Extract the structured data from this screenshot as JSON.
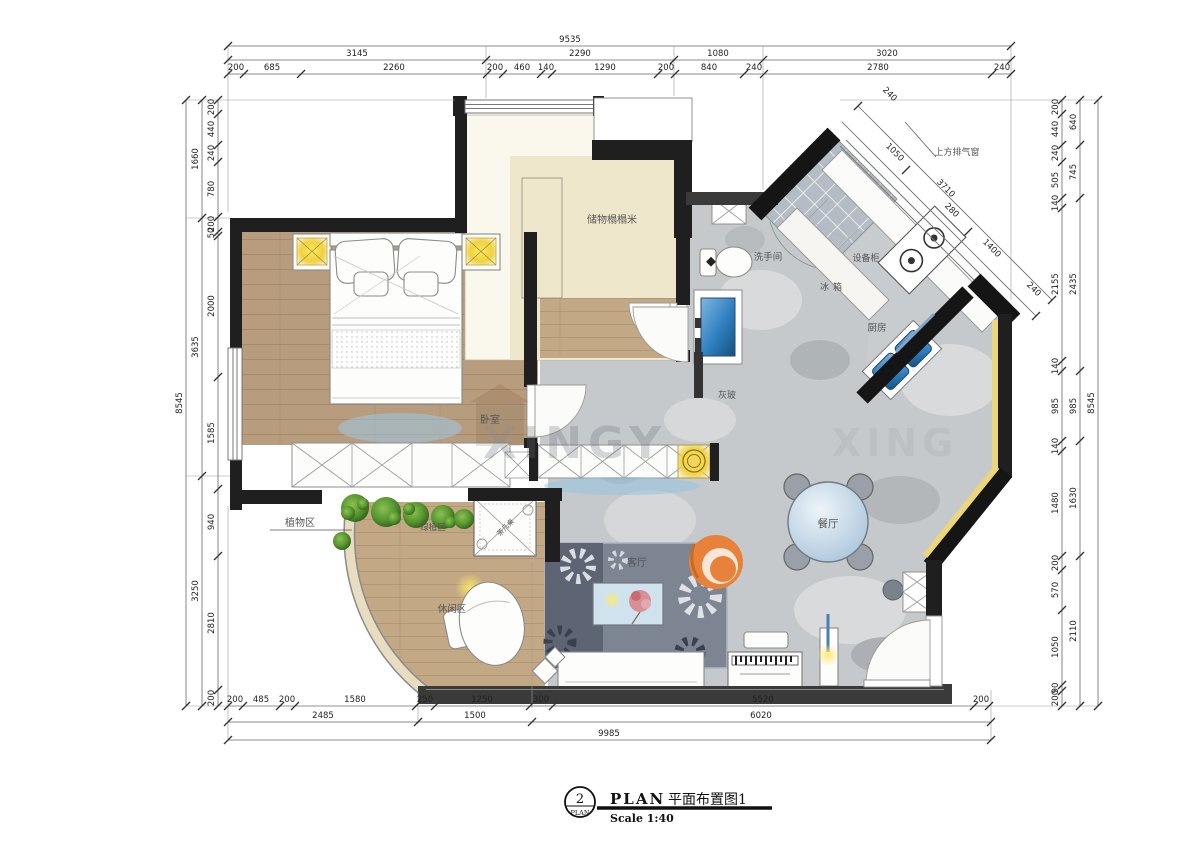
{
  "title_block": {
    "circle_number": "2",
    "circle_text": "PLAN",
    "title_en": "PLAN",
    "title_cn": "平面布置图1",
    "scale": "Scale 1:40"
  },
  "labels": {
    "tatami": "储物榻榻米",
    "bedroom": "卧室",
    "bathroom": "洗手间",
    "gray_glass": "灰玻",
    "exhaust_window": "上方排气窗",
    "equipment_cabinet": "设备柜",
    "fridge": "冰箱",
    "kitchen": "厨房",
    "dining": "餐厅",
    "living": "客厅",
    "plant_zone": "植物区",
    "green_plant_zone": "绿植区",
    "leisure_zone": "休闲区",
    "tea_table": "茶几桌"
  },
  "watermark": {
    "text_main": "XINGY",
    "text_side": "XING"
  },
  "dims": {
    "top_total": [
      "9535"
    ],
    "top_mid": [
      "3145",
      "2290",
      "1080",
      "3020"
    ],
    "top_inner": [
      "200",
      "685",
      "2260",
      "200",
      "460",
      "140",
      "1290",
      "200",
      "840",
      "240",
      "2780",
      "240"
    ],
    "left_outer": [
      "8545"
    ],
    "left_mid": [
      "1660",
      "3635",
      "3250"
    ],
    "left_inner": [
      "200",
      "440",
      "240",
      "780",
      "200",
      "50",
      "2000",
      "1585",
      "940",
      "2810",
      "200"
    ],
    "right_outer": [
      "8545"
    ],
    "right_mid": [
      "640",
      "745",
      "2435",
      "985",
      "1630",
      "2110"
    ],
    "right_inner": [
      "200",
      "440",
      "240",
      "505",
      "140",
      "2155",
      "140",
      "985",
      "140",
      "1480",
      "200",
      "570",
      "1050",
      "90",
      "200"
    ],
    "bottom_inner": [
      "200",
      "485",
      "200",
      "1580",
      "250",
      "1250",
      "300",
      "5520",
      "200"
    ],
    "bottom_mid": [
      "2485",
      "1500",
      "6020"
    ],
    "bottom_total": [
      "9985"
    ],
    "diag": [
      "240",
      "1050",
      "3710",
      "280",
      "1400",
      "240"
    ]
  },
  "colors": {
    "wall": "#1f1f1f",
    "wood": "#b79c7e",
    "marble": "#c6c9cb",
    "tatami_cream": "#efe7cc",
    "accent_yellow": "#ecd67c",
    "accent_orange": "#e8823b",
    "water_blue": "#2f7fc0",
    "tree_green": "#4e8f33",
    "rug_slate": "#7d8593"
  }
}
